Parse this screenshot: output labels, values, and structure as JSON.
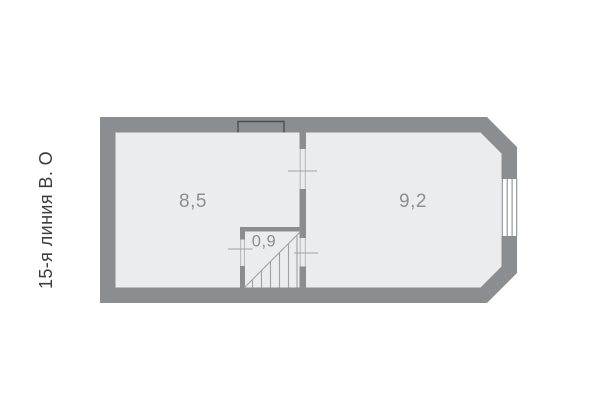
{
  "street_label": "15-я линия В. О",
  "plan": {
    "rooms": [
      {
        "name": "room-left",
        "area": "8,5"
      },
      {
        "name": "room-right",
        "area": "9,2"
      },
      {
        "name": "stairwell",
        "area": "0,9"
      }
    ],
    "colors": {
      "background": "#ffffff",
      "wall": "#8b8e90",
      "floor": "#ebecee",
      "room_label": "#8c8f92",
      "thin_line": "#9fa2a4",
      "jamb_line": "#b4b7b9",
      "niche_outline": "#4c4f51",
      "street_label_text": "#3c3c3e"
    }
  }
}
